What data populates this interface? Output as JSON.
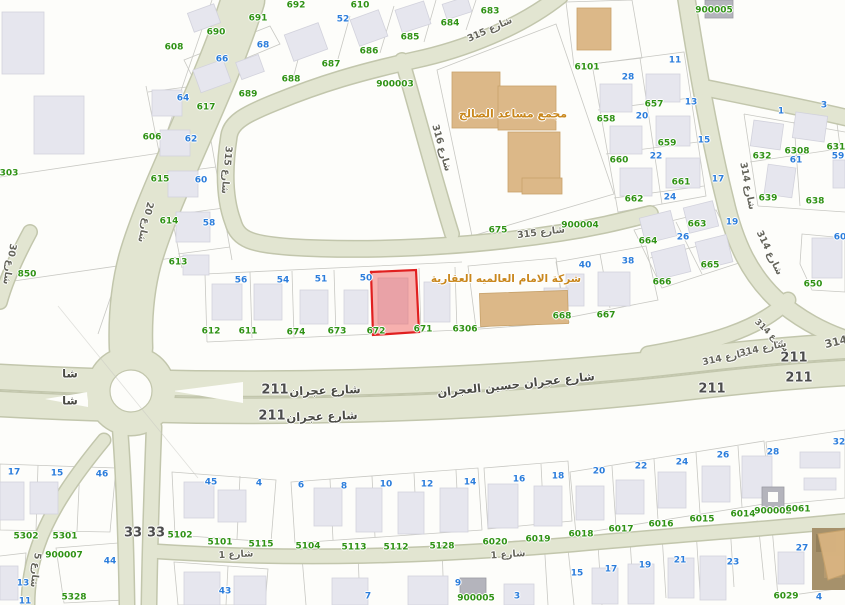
{
  "map": {
    "highlighted_parcel": {
      "parcel_number": "672",
      "fill": "#ef4444",
      "border": "#e01f1f"
    },
    "main_street": {
      "name": "شارع عجران حسين العجران",
      "route_number": "211"
    },
    "landmarks": [
      {
        "name": "مجمع مساعد الصالح"
      },
      {
        "name": "شركة الامام العالميه العقارية"
      }
    ],
    "street_names": [
      "شارع 20",
      "شارع 30",
      "شارع 315",
      "شارع 316",
      "شارع 314",
      "شارع 1",
      "شارع 5",
      "شارع عجران حسين العجران"
    ],
    "route_numbers": [
      "211",
      "33",
      "314"
    ],
    "survey_numbers": [
      "900002",
      "900003",
      "900004",
      "900005",
      "900007"
    ],
    "colors": {
      "street_fill": "#e2e5d1",
      "street_edge": "#c2c6ac",
      "building": "#e6e6ee",
      "landmark_building": "#dcb888",
      "parcel_line": "#c8c8c3",
      "parcel_number_green": "#2f9214",
      "house_number_blue": "#2b7ddb",
      "road_number_gray": "#4c4c4c",
      "landmark_text": "#c9871c",
      "highlight_fill": "rgba(239,68,68,0.42)",
      "highlight_border": "#e01f1f"
    }
  },
  "labels": [
    {
      "t": "610",
      "c": "g",
      "x": 360,
      "y": 6
    },
    {
      "t": "692",
      "c": "g",
      "x": 296,
      "y": 6
    },
    {
      "t": "691",
      "c": "g",
      "x": 258,
      "y": 19
    },
    {
      "t": "690",
      "c": "g",
      "x": 216,
      "y": 33
    },
    {
      "t": "608",
      "c": "g",
      "x": 174,
      "y": 48
    },
    {
      "t": "689",
      "c": "g",
      "x": 248,
      "y": 95
    },
    {
      "t": "688",
      "c": "g",
      "x": 291,
      "y": 80
    },
    {
      "t": "687",
      "c": "g",
      "x": 331,
      "y": 65
    },
    {
      "t": "686",
      "c": "g",
      "x": 369,
      "y": 52
    },
    {
      "t": "685",
      "c": "g",
      "x": 410,
      "y": 38
    },
    {
      "t": "684",
      "c": "g",
      "x": 450,
      "y": 24
    },
    {
      "t": "683",
      "c": "g",
      "x": 490,
      "y": 12
    },
    {
      "t": "606",
      "c": "g",
      "x": 152,
      "y": 138
    },
    {
      "t": "617",
      "c": "g",
      "x": 206,
      "y": 108
    },
    {
      "t": "615",
      "c": "g",
      "x": 160,
      "y": 180
    },
    {
      "t": "614",
      "c": "g",
      "x": 169,
      "y": 222
    },
    {
      "t": "613",
      "c": "g",
      "x": 178,
      "y": 263
    },
    {
      "t": "612",
      "c": "g",
      "x": 211,
      "y": 332
    },
    {
      "t": "611",
      "c": "g",
      "x": 248,
      "y": 332
    },
    {
      "t": "303",
      "c": "g",
      "x": 9,
      "y": 174
    },
    {
      "t": "850",
      "c": "g",
      "x": 27,
      "y": 275
    },
    {
      "t": "900003",
      "c": "g",
      "x": 395,
      "y": 85
    },
    {
      "t": "900005",
      "c": "g",
      "x": 714,
      "y": 11
    },
    {
      "t": "6101",
      "c": "g",
      "x": 587,
      "y": 68
    },
    {
      "t": "657",
      "c": "g",
      "x": 654,
      "y": 105
    },
    {
      "t": "658",
      "c": "g",
      "x": 606,
      "y": 120
    },
    {
      "t": "659",
      "c": "g",
      "x": 667,
      "y": 144
    },
    {
      "t": "660",
      "c": "g",
      "x": 619,
      "y": 161
    },
    {
      "t": "661",
      "c": "g",
      "x": 681,
      "y": 183
    },
    {
      "t": "662",
      "c": "g",
      "x": 634,
      "y": 200
    },
    {
      "t": "663",
      "c": "g",
      "x": 697,
      "y": 225
    },
    {
      "t": "664",
      "c": "g",
      "x": 648,
      "y": 242
    },
    {
      "t": "665",
      "c": "g",
      "x": 710,
      "y": 266
    },
    {
      "t": "666",
      "c": "g",
      "x": 662,
      "y": 283
    },
    {
      "t": "900004",
      "c": "g",
      "x": 580,
      "y": 226
    },
    {
      "t": "675",
      "c": "g",
      "x": 498,
      "y": 231
    },
    {
      "t": "632",
      "c": "g",
      "x": 762,
      "y": 157
    },
    {
      "t": "6308",
      "c": "g",
      "x": 797,
      "y": 152
    },
    {
      "t": "6317",
      "c": "g",
      "x": 839,
      "y": 148
    },
    {
      "t": "639",
      "c": "g",
      "x": 768,
      "y": 199
    },
    {
      "t": "638",
      "c": "g",
      "x": 815,
      "y": 202
    },
    {
      "t": "650",
      "c": "g",
      "x": 813,
      "y": 285
    },
    {
      "t": "667",
      "c": "g",
      "x": 606,
      "y": 316
    },
    {
      "t": "668",
      "c": "g",
      "x": 562,
      "y": 317
    },
    {
      "t": "674",
      "c": "g",
      "x": 296,
      "y": 333
    },
    {
      "t": "673",
      "c": "g",
      "x": 337,
      "y": 332
    },
    {
      "t": "672",
      "c": "g",
      "x": 376,
      "y": 332
    },
    {
      "t": "671",
      "c": "g",
      "x": 423,
      "y": 330
    },
    {
      "t": "6306",
      "c": "g",
      "x": 465,
      "y": 330
    },
    {
      "t": "5302",
      "c": "g",
      "x": 26,
      "y": 537
    },
    {
      "t": "5301",
      "c": "g",
      "x": 65,
      "y": 537
    },
    {
      "t": "900007",
      "c": "g",
      "x": 64,
      "y": 556
    },
    {
      "t": "5328",
      "c": "g",
      "x": 74,
      "y": 598
    },
    {
      "t": "5102",
      "c": "g",
      "x": 180,
      "y": 536
    },
    {
      "t": "5101",
      "c": "g",
      "x": 220,
      "y": 543
    },
    {
      "t": "5115",
      "c": "g",
      "x": 261,
      "y": 545
    },
    {
      "t": "5104",
      "c": "g",
      "x": 308,
      "y": 547
    },
    {
      "t": "5113",
      "c": "g",
      "x": 354,
      "y": 548
    },
    {
      "t": "5112",
      "c": "g",
      "x": 396,
      "y": 548
    },
    {
      "t": "5128",
      "c": "g",
      "x": 442,
      "y": 547
    },
    {
      "t": "6020",
      "c": "g",
      "x": 495,
      "y": 543
    },
    {
      "t": "6019",
      "c": "g",
      "x": 538,
      "y": 540
    },
    {
      "t": "6018",
      "c": "g",
      "x": 581,
      "y": 535
    },
    {
      "t": "6017",
      "c": "g",
      "x": 621,
      "y": 530
    },
    {
      "t": "6016",
      "c": "g",
      "x": 661,
      "y": 525
    },
    {
      "t": "6015",
      "c": "g",
      "x": 702,
      "y": 520
    },
    {
      "t": "6014",
      "c": "g",
      "x": 743,
      "y": 515
    },
    {
      "t": "900002",
      "c": "g",
      "x": 773,
      "y": 512
    },
    {
      "t": "6061",
      "c": "g",
      "x": 798,
      "y": 510
    },
    {
      "t": "6029",
      "c": "g",
      "x": 786,
      "y": 597
    },
    {
      "t": "900005",
      "c": "g",
      "x": 476,
      "y": 599
    },
    {
      "t": "66",
      "c": "b",
      "x": 222,
      "y": 60
    },
    {
      "t": "68",
      "c": "b",
      "x": 263,
      "y": 46
    },
    {
      "t": "52",
      "c": "b",
      "x": 343,
      "y": 20
    },
    {
      "t": "64",
      "c": "b",
      "x": 183,
      "y": 99
    },
    {
      "t": "62",
      "c": "b",
      "x": 191,
      "y": 140
    },
    {
      "t": "60",
      "c": "b",
      "x": 201,
      "y": 181
    },
    {
      "t": "58",
      "c": "b",
      "x": 209,
      "y": 224
    },
    {
      "t": "56",
      "c": "b",
      "x": 241,
      "y": 281
    },
    {
      "t": "54",
      "c": "b",
      "x": 283,
      "y": 281
    },
    {
      "t": "51",
      "c": "b",
      "x": 321,
      "y": 280
    },
    {
      "t": "50",
      "c": "b",
      "x": 366,
      "y": 279
    },
    {
      "t": "28",
      "c": "b",
      "x": 628,
      "y": 78
    },
    {
      "t": "11",
      "c": "b",
      "x": 675,
      "y": 61
    },
    {
      "t": "13",
      "c": "b",
      "x": 691,
      "y": 103
    },
    {
      "t": "20",
      "c": "b",
      "x": 642,
      "y": 117
    },
    {
      "t": "15",
      "c": "b",
      "x": 704,
      "y": 141
    },
    {
      "t": "22",
      "c": "b",
      "x": 656,
      "y": 157
    },
    {
      "t": "17",
      "c": "b",
      "x": 718,
      "y": 180
    },
    {
      "t": "24",
      "c": "b",
      "x": 670,
      "y": 198
    },
    {
      "t": "19",
      "c": "b",
      "x": 732,
      "y": 223
    },
    {
      "t": "26",
      "c": "b",
      "x": 683,
      "y": 238
    },
    {
      "t": "1",
      "c": "b",
      "x": 781,
      "y": 112
    },
    {
      "t": "3",
      "c": "b",
      "x": 824,
      "y": 106
    },
    {
      "t": "61",
      "c": "b",
      "x": 796,
      "y": 161
    },
    {
      "t": "59",
      "c": "b",
      "x": 838,
      "y": 157
    },
    {
      "t": "60",
      "c": "b",
      "x": 840,
      "y": 238
    },
    {
      "t": "40",
      "c": "b",
      "x": 585,
      "y": 266
    },
    {
      "t": "38",
      "c": "b",
      "x": 628,
      "y": 262
    },
    {
      "t": "17",
      "c": "b",
      "x": 14,
      "y": 473
    },
    {
      "t": "15",
      "c": "b",
      "x": 57,
      "y": 474
    },
    {
      "t": "46",
      "c": "b",
      "x": 102,
      "y": 475
    },
    {
      "t": "45",
      "c": "b",
      "x": 211,
      "y": 483
    },
    {
      "t": "4",
      "c": "b",
      "x": 259,
      "y": 484
    },
    {
      "t": "44",
      "c": "b",
      "x": 110,
      "y": 562
    },
    {
      "t": "13",
      "c": "b",
      "x": 23,
      "y": 584
    },
    {
      "t": "11",
      "c": "b",
      "x": 25,
      "y": 602
    },
    {
      "t": "43",
      "c": "b",
      "x": 225,
      "y": 592
    },
    {
      "t": "6",
      "c": "b",
      "x": 301,
      "y": 486
    },
    {
      "t": "8",
      "c": "b",
      "x": 344,
      "y": 487
    },
    {
      "t": "10",
      "c": "b",
      "x": 386,
      "y": 485
    },
    {
      "t": "12",
      "c": "b",
      "x": 427,
      "y": 485
    },
    {
      "t": "14",
      "c": "b",
      "x": 470,
      "y": 483
    },
    {
      "t": "16",
      "c": "b",
      "x": 519,
      "y": 480
    },
    {
      "t": "18",
      "c": "b",
      "x": 558,
      "y": 477
    },
    {
      "t": "7",
      "c": "b",
      "x": 368,
      "y": 597
    },
    {
      "t": "9",
      "c": "b",
      "x": 458,
      "y": 584
    },
    {
      "t": "3",
      "c": "b",
      "x": 517,
      "y": 597
    },
    {
      "t": "20",
      "c": "b",
      "x": 599,
      "y": 472
    },
    {
      "t": "22",
      "c": "b",
      "x": 641,
      "y": 467
    },
    {
      "t": "24",
      "c": "b",
      "x": 682,
      "y": 463
    },
    {
      "t": "26",
      "c": "b",
      "x": 723,
      "y": 456
    },
    {
      "t": "28",
      "c": "b",
      "x": 773,
      "y": 453
    },
    {
      "t": "32",
      "c": "b",
      "x": 839,
      "y": 443
    },
    {
      "t": "15",
      "c": "b",
      "x": 577,
      "y": 574
    },
    {
      "t": "17",
      "c": "b",
      "x": 611,
      "y": 570
    },
    {
      "t": "19",
      "c": "b",
      "x": 645,
      "y": 566
    },
    {
      "t": "21",
      "c": "b",
      "x": 680,
      "y": 561
    },
    {
      "t": "23",
      "c": "b",
      "x": 733,
      "y": 563
    },
    {
      "t": "27",
      "c": "b",
      "x": 802,
      "y": 549
    },
    {
      "t": "4",
      "c": "b",
      "x": 819,
      "y": 598
    },
    {
      "t": "211",
      "c": "r",
      "x": 275,
      "y": 390
    },
    {
      "t": "211",
      "c": "r",
      "x": 272,
      "y": 416
    },
    {
      "t": "211",
      "c": "r",
      "x": 794,
      "y": 358
    },
    {
      "t": "211",
      "c": "r",
      "x": 799,
      "y": 378
    },
    {
      "t": "211",
      "c": "r",
      "x": 712,
      "y": 389
    },
    {
      "t": "33",
      "c": "r",
      "x": 133,
      "y": 533
    },
    {
      "t": "33",
      "c": "r",
      "x": 156,
      "y": 533
    },
    {
      "t": "20 شارع",
      "c": "s",
      "x": 145,
      "y": 222,
      "r": 103
    },
    {
      "t": "30 شارع",
      "c": "s",
      "x": 9,
      "y": 264,
      "r": 100
    },
    {
      "t": "315 شارع",
      "c": "s",
      "x": 226,
      "y": 170,
      "r": 95
    },
    {
      "t": "316 شارع",
      "c": "s",
      "x": 441,
      "y": 148,
      "r": 74
    },
    {
      "t": "315 شارع",
      "c": "s",
      "x": 490,
      "y": 30,
      "r": -24
    },
    {
      "t": "315 شارع",
      "c": "s",
      "x": 541,
      "y": 233,
      "r": -7
    },
    {
      "t": "314 شارع",
      "c": "s",
      "x": 747,
      "y": 186,
      "r": 79
    },
    {
      "t": "314 شارع",
      "c": "s",
      "x": 769,
      "y": 253,
      "r": 64
    },
    {
      "t": "314 شارع",
      "c": "s",
      "x": 771,
      "y": 336,
      "r": 44,
      "fs": 8.5
    },
    {
      "t": "314 شارع",
      "c": "s",
      "x": 726,
      "y": 358,
      "r": -12
    },
    {
      "t": "314 شارع",
      "c": "s",
      "x": 763,
      "y": 349,
      "r": -12
    },
    {
      "t": "314",
      "c": "s",
      "x": 836,
      "y": 342,
      "r": -14,
      "fs": 11
    },
    {
      "t": "شارع 1",
      "c": "s",
      "x": 236,
      "y": 555,
      "r": -3
    },
    {
      "t": "شارع 1",
      "c": "s",
      "x": 508,
      "y": 555,
      "r": -4
    },
    {
      "t": "5 شارع",
      "c": "s",
      "x": 35,
      "y": 570,
      "r": 97
    },
    {
      "t": "شا",
      "c": "n",
      "x": 70,
      "y": 374
    },
    {
      "t": "شا",
      "c": "n",
      "x": 70,
      "y": 401
    },
    {
      "t": "شارع عجران",
      "c": "n",
      "x": 325,
      "y": 391,
      "r": -2
    },
    {
      "t": "شارع عجران",
      "c": "n",
      "x": 322,
      "y": 417,
      "r": -2
    },
    {
      "t": "شارع عجران حسين العجران",
      "c": "n",
      "x": 516,
      "y": 385,
      "r": -6
    },
    {
      "t": "مجمع مساعد الصالح",
      "c": "l",
      "x": 513,
      "y": 114
    },
    {
      "t": "شركة الامام العالميه العقارية",
      "c": "l",
      "x": 506,
      "y": 279,
      "fs": 10.5
    }
  ]
}
